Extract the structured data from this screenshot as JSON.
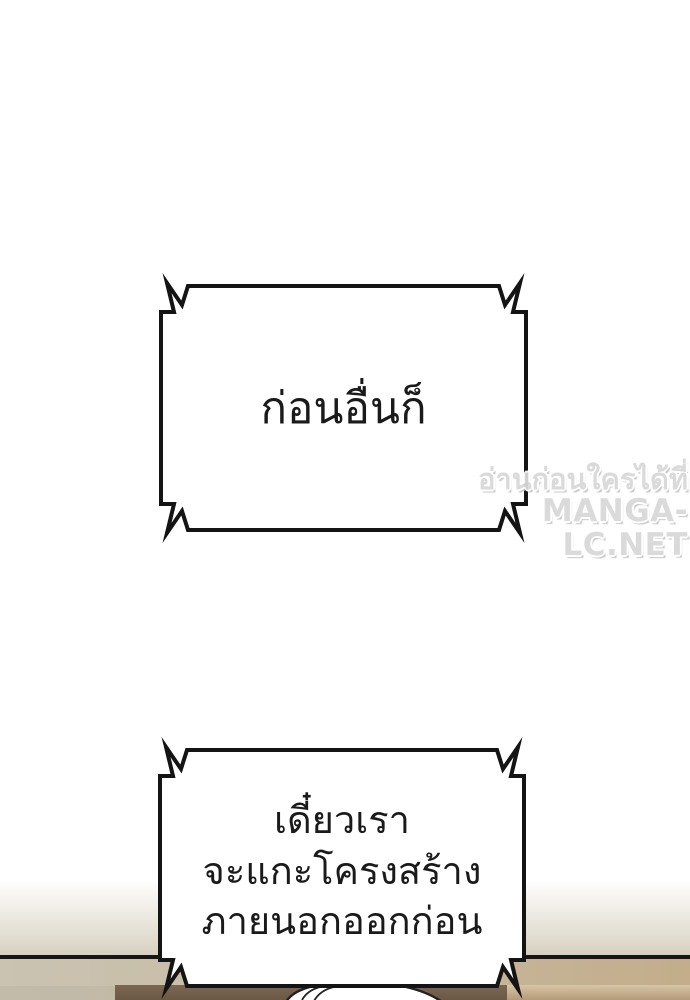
{
  "page": {
    "background_color": "#ffffff",
    "ink_color": "#141414"
  },
  "bubbles": [
    {
      "text": "ก่อนอื่นก็"
    },
    {
      "lines": [
        "เดี๋ยวเรา",
        "จะแกะโครงสร้าง",
        "ภายนอกออกก่อน"
      ]
    }
  ],
  "watermark": {
    "tagline": "อ่านก่อนใครได้ที่",
    "site": "MANGA-LC.NET",
    "color": "#d9d9d9"
  },
  "artwork": {
    "wall_light_color": "#d6cfbf",
    "floor_dark_color": "#6b5945",
    "floor_tan_color": "#c3ad8b",
    "head_outline_color": "#222222"
  }
}
